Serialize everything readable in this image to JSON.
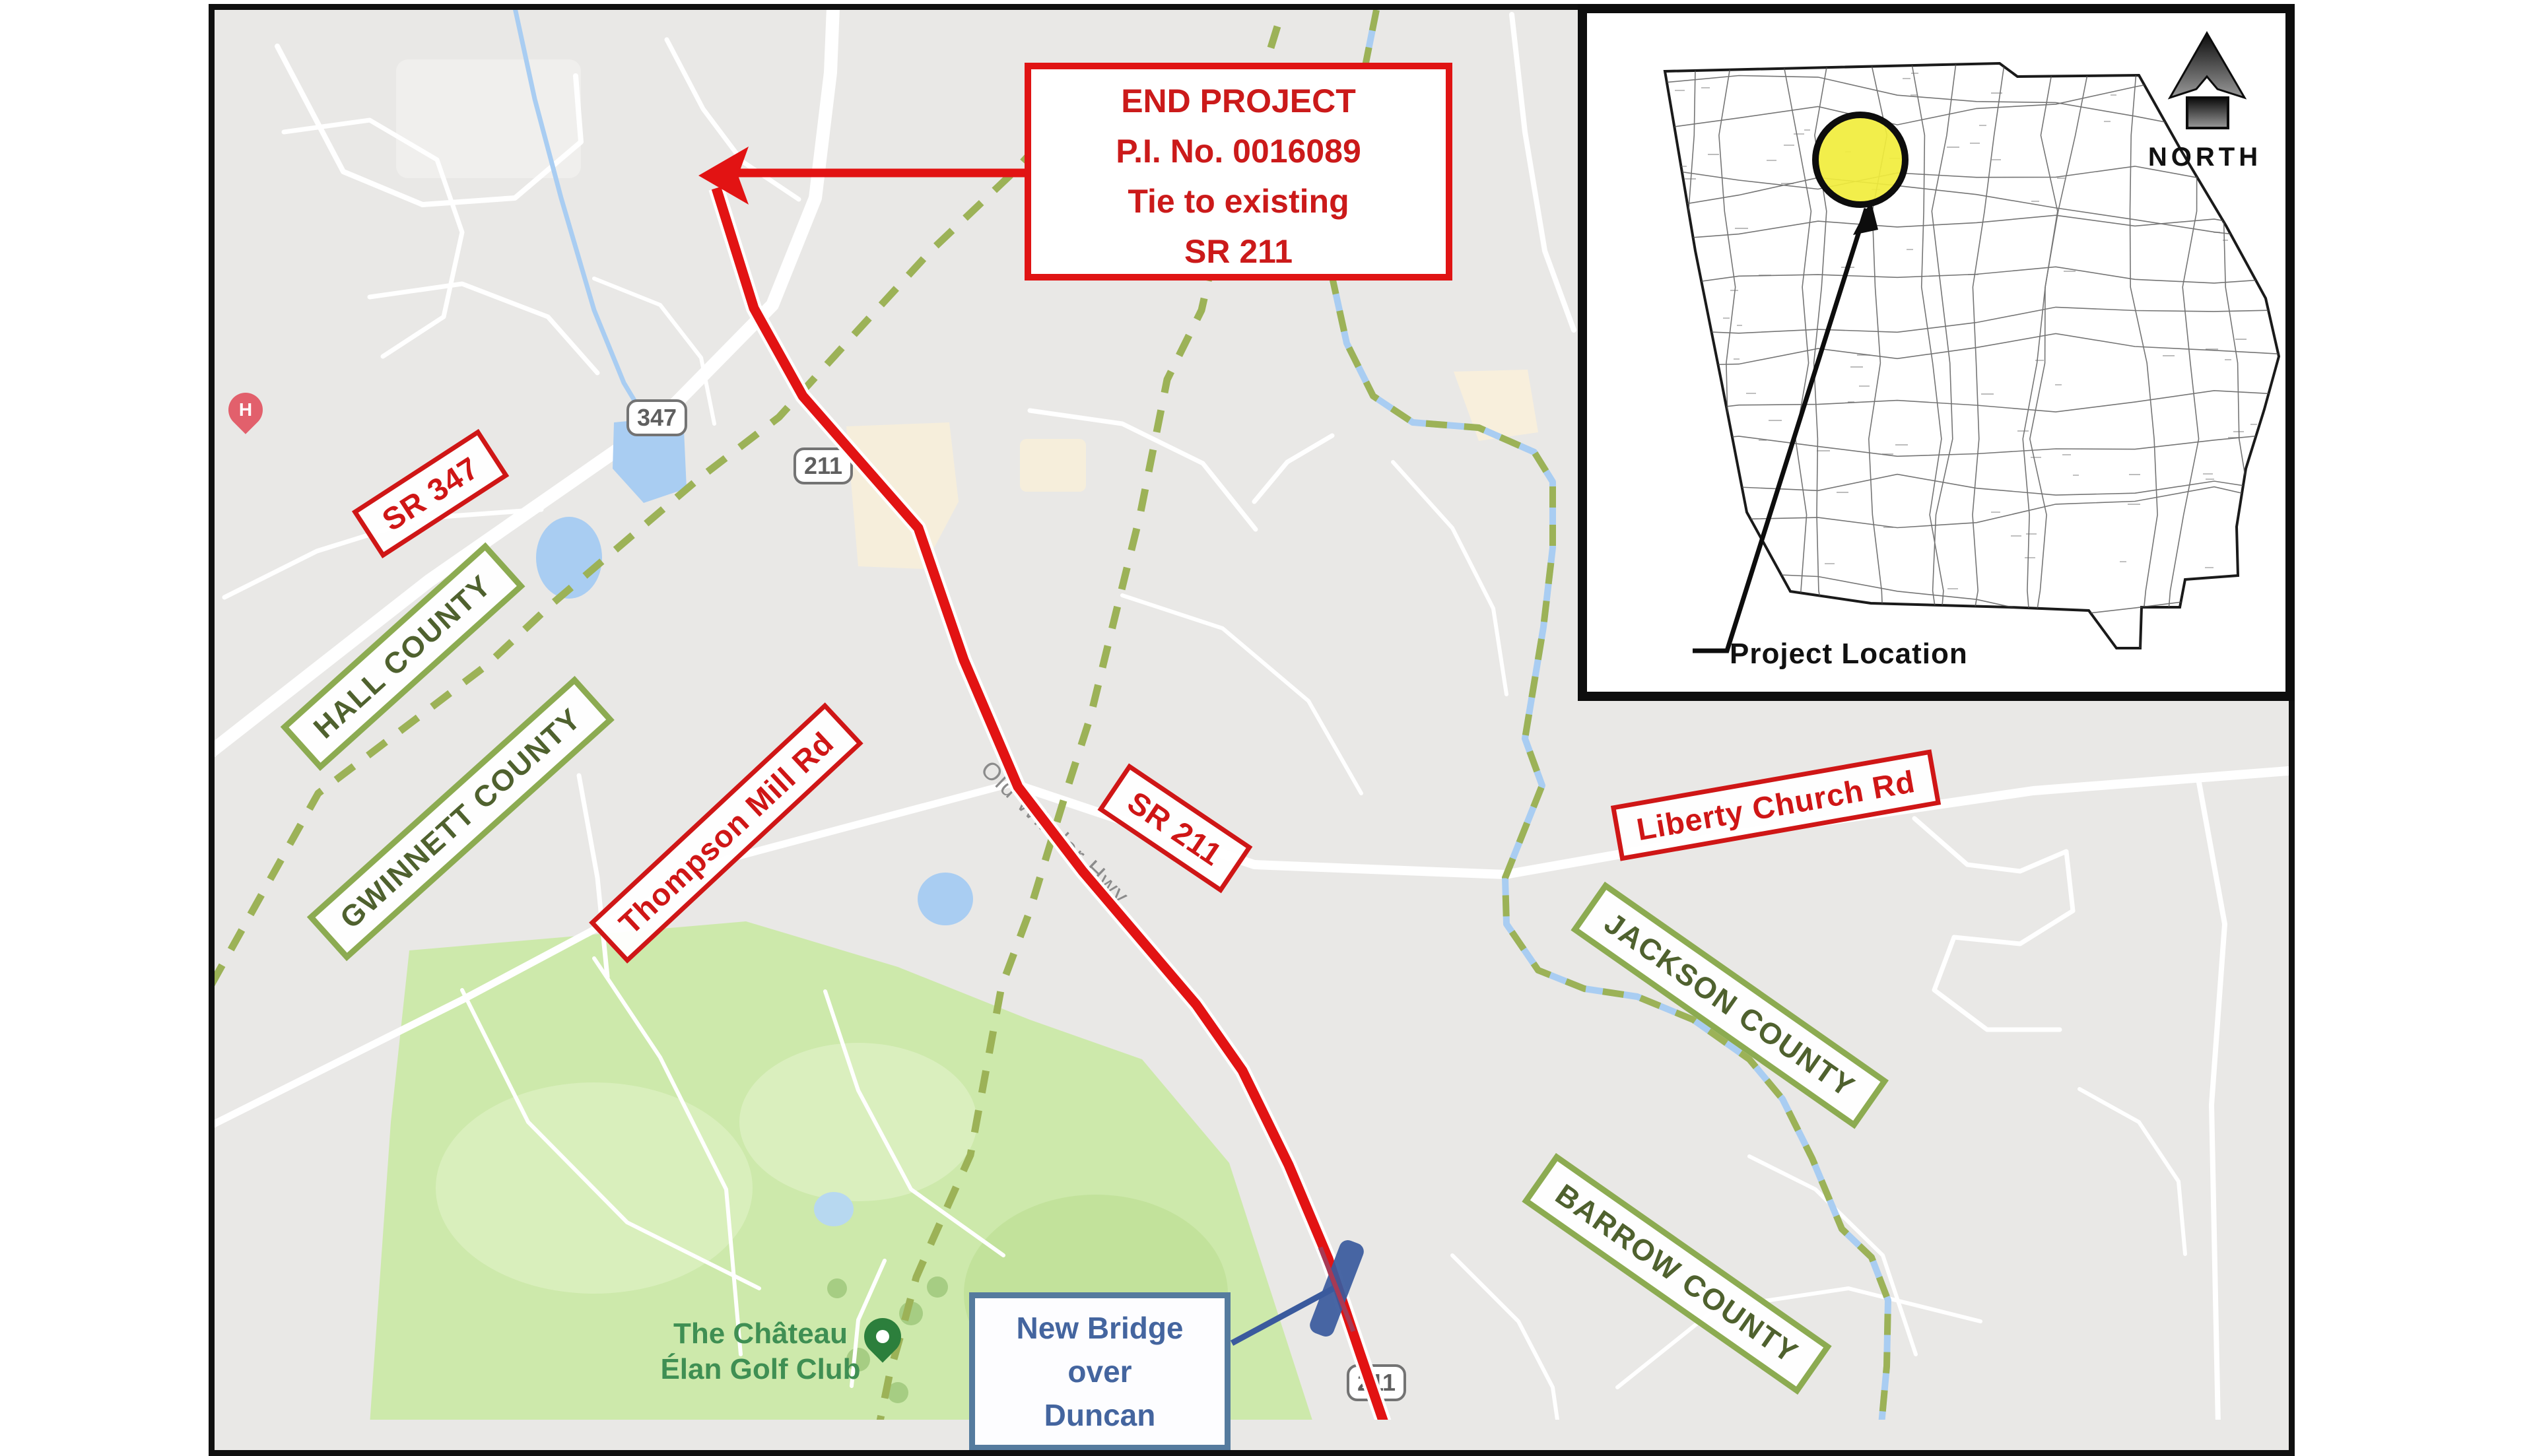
{
  "end_project_box": {
    "line1": "END PROJECT",
    "line2": "P.I. No. 0016089",
    "line3": "Tie to existing",
    "line4": "SR 211"
  },
  "road_labels": {
    "sr_347": "SR 347",
    "thompson_mill_rd": "Thompson Mill Rd",
    "sr_211": "SR 211",
    "liberty_church_rd": "Liberty Church Rd"
  },
  "county_labels": {
    "hall": "HALL COUNTY",
    "gwinnett": "GWINNETT COUNTY",
    "jackson": "JACKSON COUNTY",
    "barrow": "BARROW COUNTY"
  },
  "bridge_callout": {
    "line1": "New Bridge",
    "line2": "over",
    "line3": "Duncan"
  },
  "map_texts": {
    "old_winder_hwy": "Old Winder Hwy",
    "golf_club_line1": "The Château",
    "golf_club_line2": "Élan Golf Club",
    "hospital_marker": "H"
  },
  "route_shields": {
    "sr_347": "347",
    "sr_211_north": "211",
    "sr_211_south": "211"
  },
  "inset": {
    "north_label": "NORTH",
    "project_location_label": "Project Location"
  },
  "colors": {
    "project_route_red": "#e21313",
    "label_red": "#cf1616",
    "county_green_border": "#8cab51",
    "county_green_text": "#4f612e",
    "boundary_dash_green": "#9cb257",
    "water_blue": "#a9cdf2",
    "golf_green": "#cde9ab",
    "bridge_marker_navy": "#3a5a9d",
    "callout_blue": "#44659f",
    "highlight_yellow": "#f1ed3c",
    "map_background": "#e9e8e6"
  }
}
